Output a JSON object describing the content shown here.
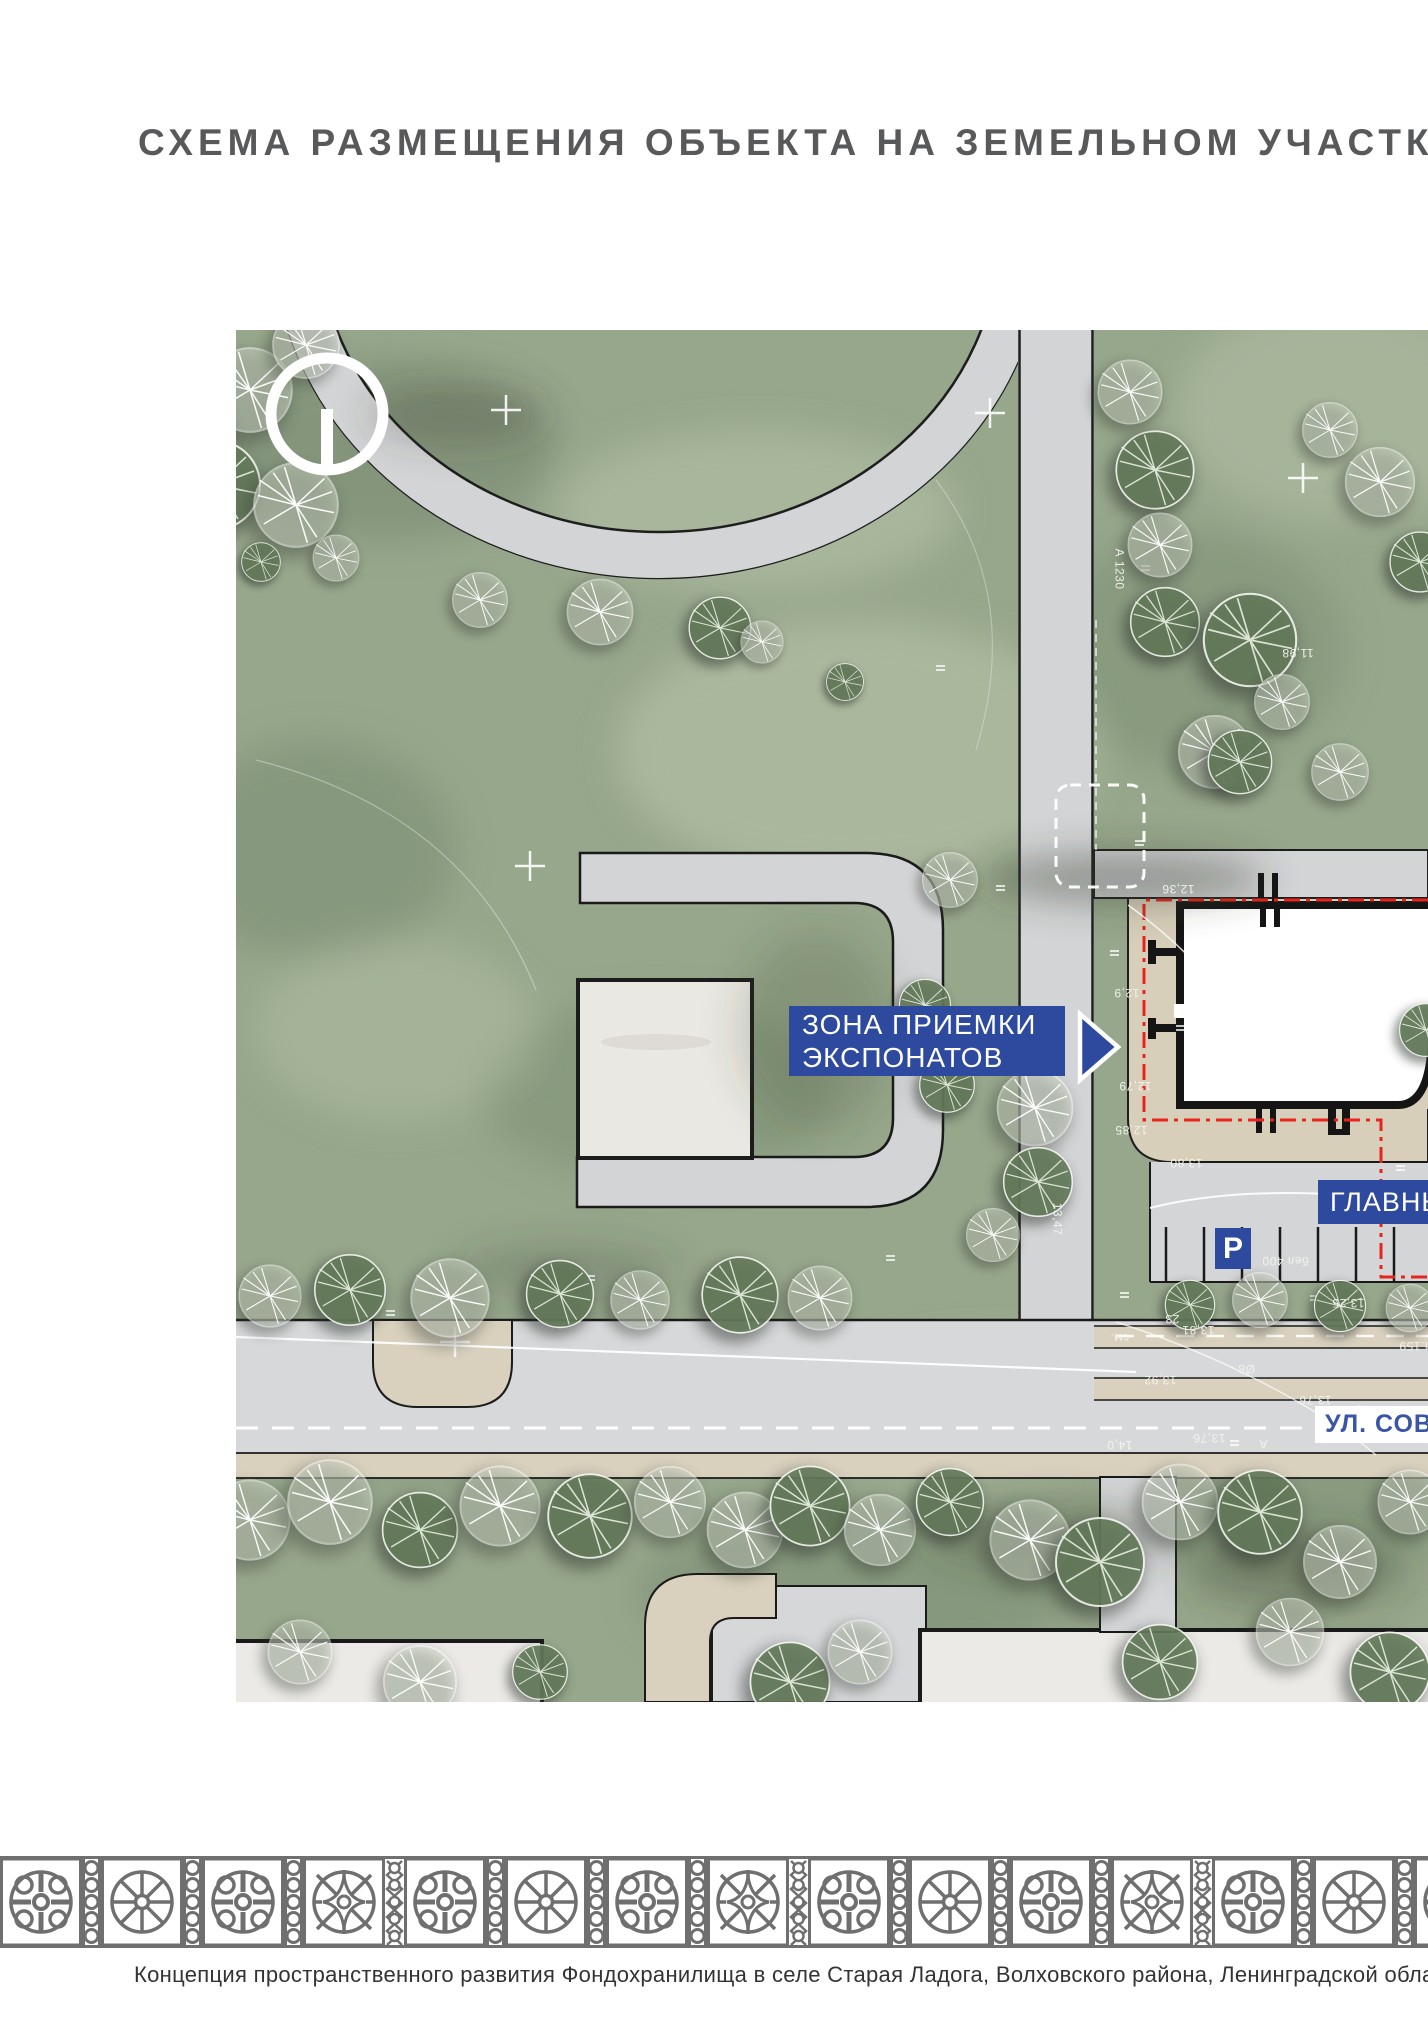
{
  "page": {
    "title": "СХЕМА РАЗМЕЩЕНИЯ ОБЪЕКТА НА ЗЕМЕЛЬНОМ УЧАСТКЕ",
    "caption": "Концепция пространственного развития Фондохранилища в селе Старая Ладога, Волховского района, Ленинградской области"
  },
  "plan": {
    "labels": {
      "delivery_zone_line1": "ЗОНА ПРИЕМКИ",
      "delivery_zone_line2": "ЭКСПОНАТОВ",
      "main_entrance": "ГЛАВНЫЙ ВХОД",
      "street": "УЛ. СОВЕТСКАЯ",
      "parking": "Р"
    },
    "colors": {
      "accent_blue": "#2e4a9f",
      "street_label_blue": "#3a55a6",
      "boundary_red": "#e8251d",
      "title_gray": "#58595b",
      "ornament_gray": "#6f6f6f",
      "lawn_green": "#97a78c",
      "road_gray": "#d3d4d6",
      "paving_beige": "#d8cfbb"
    },
    "annotations": [
      {
        "t": "11,98",
        "x": 1282,
        "y": 646,
        "r": 180
      },
      {
        "t": "12,36",
        "x": 1162,
        "y": 882,
        "r": 180
      },
      {
        "t": "12,9",
        "x": 1114,
        "y": 986,
        "r": 180
      },
      {
        "t": "12,79",
        "x": 1119,
        "y": 1079,
        "r": 180
      },
      {
        "t": "12,85",
        "x": 1115,
        "y": 1123,
        "r": 180
      },
      {
        "t": "13,80",
        "x": 1170,
        "y": 1156,
        "r": 180
      },
      {
        "t": "13,25",
        "x": 1332,
        "y": 1296,
        "r": 180
      },
      {
        "t": "23",
        "x": 1165,
        "y": 1312,
        "r": 180
      },
      {
        "t": "см.",
        "x": 1110,
        "y": 1331,
        "r": 180
      },
      {
        "t": "13,81",
        "x": 1182,
        "y": 1323,
        "r": 180
      },
      {
        "t": "сп.159",
        "x": 1399,
        "y": 1339,
        "r": 180
      },
      {
        "t": "13,92",
        "x": 1144,
        "y": 1373,
        "r": 180
      },
      {
        "t": "13,76",
        "x": 1299,
        "y": 1393,
        "r": 180
      },
      {
        "t": "13,76",
        "x": 1193,
        "y": 1431,
        "r": 180
      },
      {
        "t": "14,0",
        "x": 1107,
        "y": 1438,
        "r": 180
      },
      {
        "t": "А",
        "x": 1259,
        "y": 1437,
        "r": 180
      },
      {
        "t": "бел 400",
        "x": 1262,
        "y": 1254,
        "r": 180
      },
      {
        "t": "Ø8",
        "x": 1238,
        "y": 1362,
        "r": 180
      },
      {
        "t": "100",
        "x": 1352,
        "y": 1408,
        "r": 90
      },
      {
        "t": "А 1230",
        "x": 1099,
        "y": 562,
        "r": 90
      },
      {
        "t": "13,47",
        "x": 1041,
        "y": 1212,
        "r": 90
      }
    ]
  }
}
